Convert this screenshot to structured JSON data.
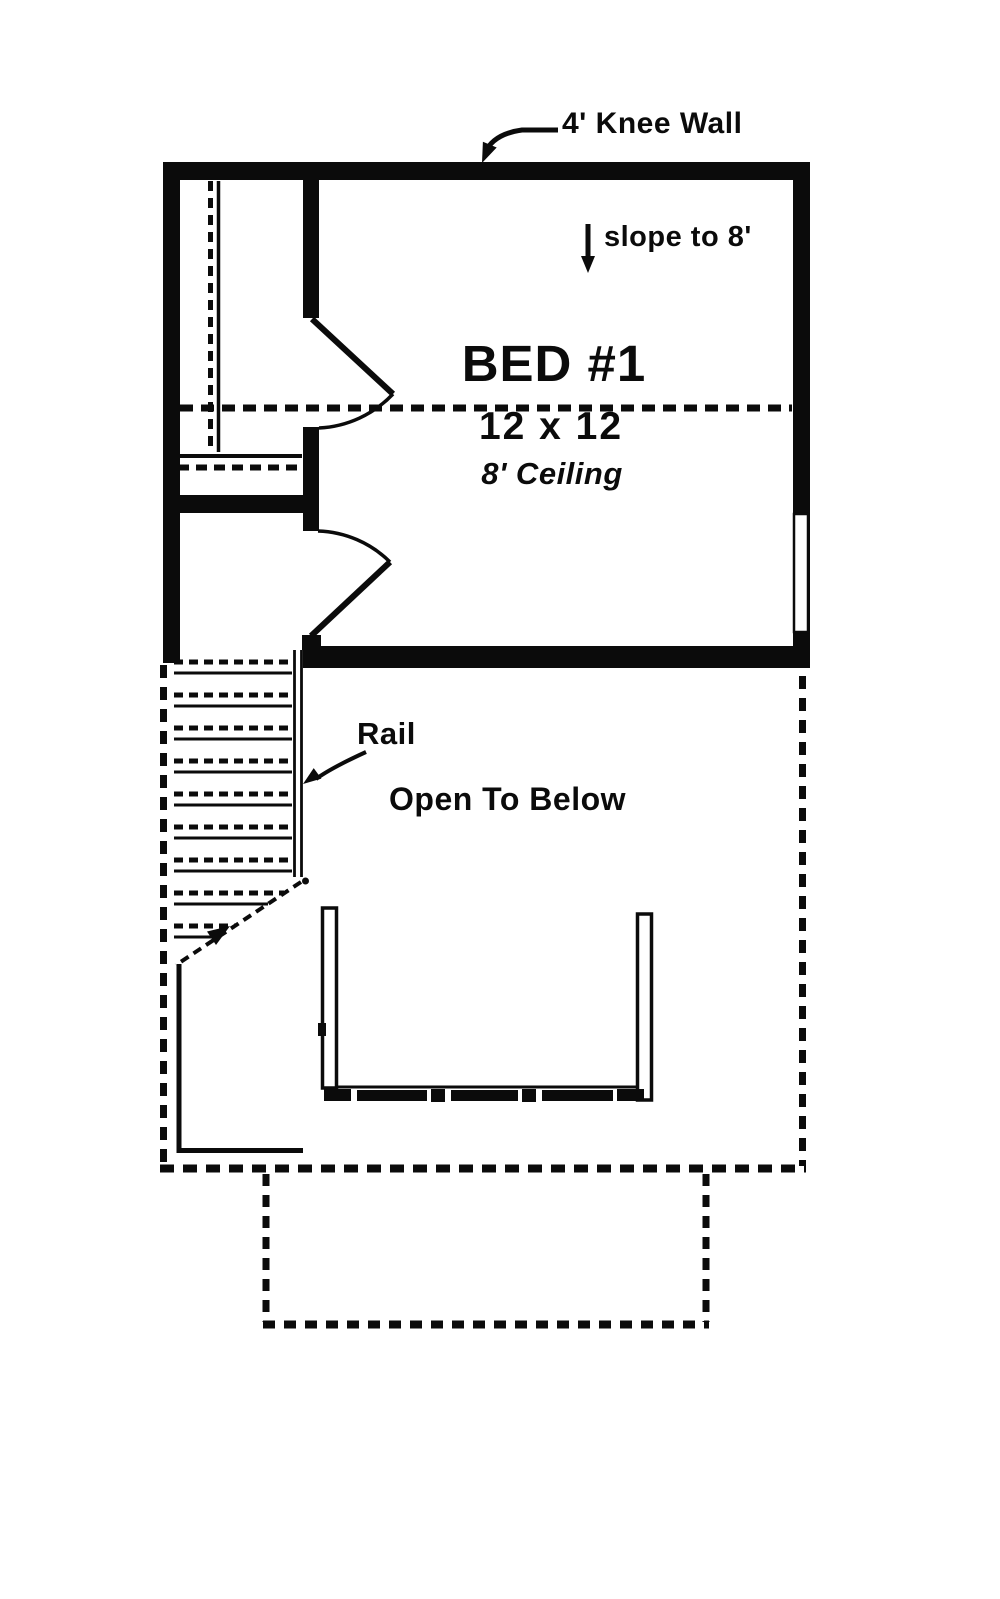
{
  "plan": {
    "labels": {
      "knee_wall": "4' Knee Wall",
      "slope": "slope to 8'",
      "room_name": "BED #1",
      "room_size": "12 x 12",
      "room_ceiling": "8' Ceiling",
      "rail": "Rail",
      "open_to_below": "Open To Below"
    },
    "colors": {
      "ink": "#0b0b0b",
      "paper": "#ffffff"
    }
  }
}
